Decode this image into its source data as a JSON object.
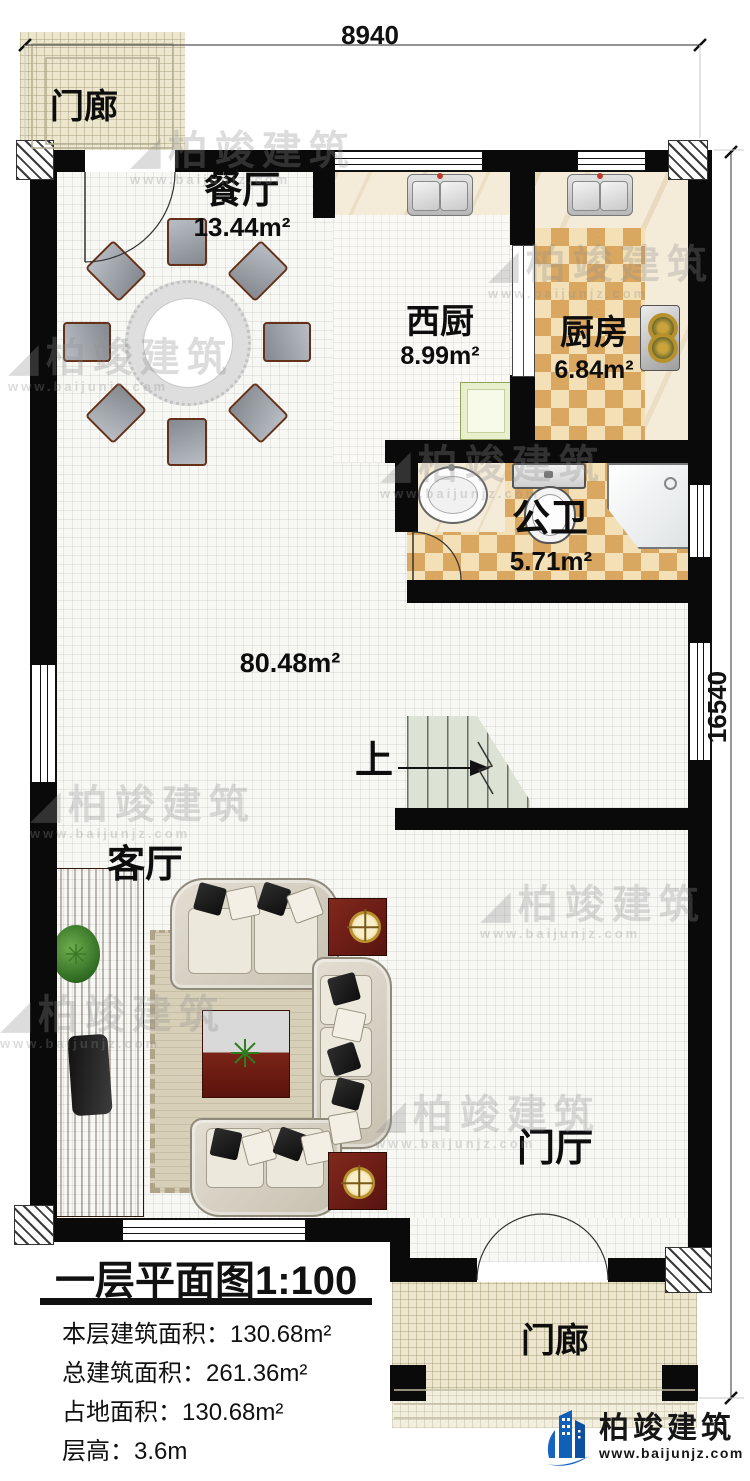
{
  "dimensions": {
    "width_top": "8940",
    "height_right": "16540"
  },
  "rooms": {
    "porch_top": {
      "label": "门廊"
    },
    "dining": {
      "label": "餐厅",
      "area": "13.44m²"
    },
    "west_kitchen": {
      "label": "西厨",
      "area": "8.99m²"
    },
    "kitchen": {
      "label": "厨房",
      "area": "6.84m²"
    },
    "bathroom": {
      "label": "公卫",
      "area": "5.71m²"
    },
    "hall": {
      "area": "80.48m²"
    },
    "living": {
      "label": "客厅"
    },
    "foyer": {
      "label": "门厅"
    },
    "porch_bottom": {
      "label": "门廊"
    },
    "stairs": {
      "up_label": "上"
    }
  },
  "info_panel": {
    "title": "一层平面图1:100",
    "lines": [
      "本层建筑面积：130.68m²",
      "总建筑面积：261.36m²",
      "占地面积：130.68m²",
      "层高：3.6m"
    ]
  },
  "branding": {
    "logo_text": "柏竣建筑",
    "website": "www.baijunjz.com"
  },
  "watermark": {
    "text": "柏竣建筑",
    "subtext": "www.baijunjz.com"
  },
  "colors": {
    "wall": "#0a0a0a",
    "checker": "#d9a75f",
    "porch_tile": "#ebe6cd",
    "logo_blue": "#1565c0"
  }
}
